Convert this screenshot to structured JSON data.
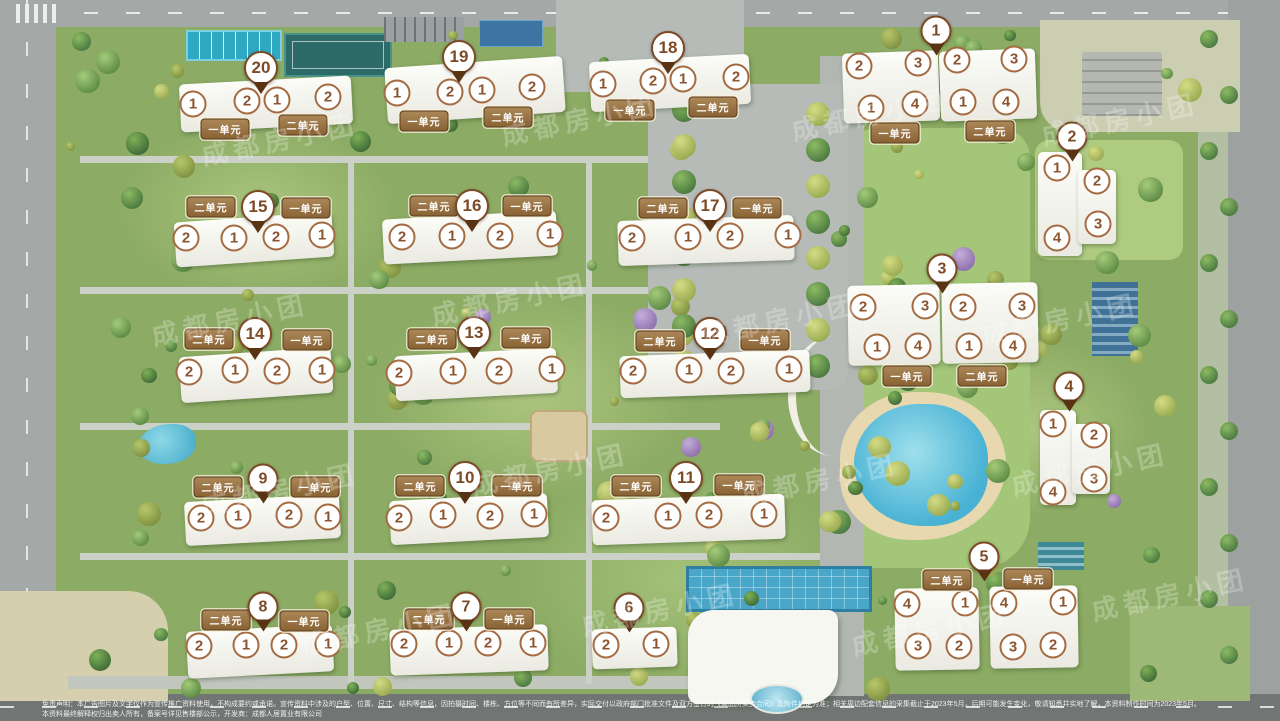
{
  "watermark": {
    "text": "成都房小团",
    "instances": [
      [
        200,
        120
      ],
      [
        500,
        100
      ],
      [
        790,
        95
      ],
      [
        1040,
        100
      ],
      [
        150,
        300
      ],
      [
        430,
        280
      ],
      [
        700,
        300
      ],
      [
        980,
        300
      ],
      [
        200,
        470
      ],
      [
        470,
        450
      ],
      [
        740,
        460
      ],
      [
        1010,
        450
      ],
      [
        300,
        610
      ],
      [
        580,
        590
      ],
      [
        850,
        610
      ],
      [
        1090,
        575
      ]
    ]
  },
  "colors": {
    "marker_brown": "#7d4a26",
    "unit_label_bg": "#96744a",
    "circle_ring": "#a46b42",
    "pool_blue": "#49b2d4",
    "lawn_green": "#8cab64",
    "road_gray": "#a4a8a6"
  },
  "disclaimer": {
    "line1": "免责声明：本广告图片及文字仅作为宣传推广资料使用，不构成要约或承诺。宣传资料中涉及的户型、位置、尺寸、结构等信息，因拍摄时间、楼栋、方位等不同而有所差异，实际交付以政府部门批准文件及双方签订的《商品房买卖合同》及附件约定为准；相关周边配套信息的采集截止于2023年5月，后期可能发生变化，敬请知悉并实地了解，本资料制作时间为2023年5月。",
    "line2": "本资料最终解释权归出卖人所有，备案号详见售楼部公示，开发商：成都人居置业有限公司"
  },
  "buildings": [
    {
      "num": "20",
      "rot": -3,
      "pin": [
        261,
        68
      ],
      "slabs": [
        [
          180,
          80,
          172,
          48
        ]
      ],
      "units": [
        [
          "一单元",
          225,
          129
        ],
        [
          "二单元",
          303,
          125
        ]
      ],
      "circles": [
        [
          "1",
          193,
          104
        ],
        [
          "2",
          247,
          101
        ],
        [
          "1",
          277,
          100
        ],
        [
          "2",
          328,
          97
        ]
      ]
    },
    {
      "num": "19",
      "rot": -4,
      "pin": [
        459,
        57
      ],
      "slabs": [
        [
          386,
          62,
          178,
          56
        ]
      ],
      "units": [
        [
          "一单元",
          424,
          121
        ],
        [
          "二单元",
          508,
          117
        ]
      ],
      "circles": [
        [
          "1",
          397,
          93
        ],
        [
          "2",
          450,
          92
        ],
        [
          "1",
          482,
          90
        ],
        [
          "2",
          532,
          87
        ]
      ]
    },
    {
      "num": "18",
      "rot": -3,
      "pin": [
        668,
        48
      ],
      "slabs": [
        [
          590,
          58,
          160,
          50
        ]
      ],
      "units": [
        [
          "一单元",
          630,
          110
        ],
        [
          "二单元",
          713,
          107
        ]
      ],
      "circles": [
        [
          "1",
          603,
          84
        ],
        [
          "2",
          653,
          81
        ],
        [
          "1",
          683,
          79
        ],
        [
          "2",
          736,
          77
        ]
      ]
    },
    {
      "num": "1",
      "rot": -2,
      "pin": [
        936,
        31
      ],
      "slabs": [
        [
          843,
          52,
          96,
          70
        ],
        [
          940,
          50,
          96,
          70
        ]
      ],
      "units": [
        [
          "一单元",
          895,
          133
        ],
        [
          "二单元",
          990,
          131
        ]
      ],
      "circles": [
        [
          "2",
          859,
          66
        ],
        [
          "3",
          918,
          63
        ],
        [
          "2",
          957,
          60
        ],
        [
          "3",
          1014,
          59
        ],
        [
          "1",
          871,
          108
        ],
        [
          "4",
          915,
          104
        ],
        [
          "1",
          963,
          102
        ],
        [
          "4",
          1006,
          102
        ]
      ]
    },
    {
      "num": "2",
      "rot": 0,
      "pin": [
        1072,
        137
      ],
      "slabs": [
        [
          1038,
          152,
          44,
          104
        ],
        [
          1078,
          170,
          38,
          74
        ]
      ],
      "units": [],
      "circles": [
        [
          "1",
          1057,
          168
        ],
        [
          "2",
          1097,
          181
        ],
        [
          "3",
          1098,
          224
        ],
        [
          "4",
          1057,
          238
        ]
      ]
    },
    {
      "num": "15",
      "rot": -4,
      "pin": [
        258,
        207
      ],
      "slabs": [
        [
          175,
          217,
          158,
          45
        ]
      ],
      "units": [
        [
          "二单元",
          211,
          207
        ],
        [
          "一单元",
          306,
          208
        ]
      ],
      "circles": [
        [
          "2",
          186,
          238
        ],
        [
          "1",
          234,
          238
        ],
        [
          "2",
          276,
          237
        ],
        [
          "1",
          322,
          235
        ]
      ]
    },
    {
      "num": "16",
      "rot": -3,
      "pin": [
        472,
        206
      ],
      "slabs": [
        [
          383,
          215,
          174,
          45
        ]
      ],
      "units": [
        [
          "二单元",
          434,
          206
        ],
        [
          "一单元",
          527,
          206
        ]
      ],
      "circles": [
        [
          "2",
          402,
          237
        ],
        [
          "1",
          452,
          236
        ],
        [
          "2",
          500,
          236
        ],
        [
          "1",
          550,
          234
        ]
      ]
    },
    {
      "num": "17",
      "rot": -2,
      "pin": [
        710,
        206
      ],
      "slabs": [
        [
          618,
          218,
          176,
          45
        ]
      ],
      "units": [
        [
          "二单元",
          663,
          208
        ],
        [
          "一单元",
          757,
          208
        ]
      ],
      "circles": [
        [
          "2",
          632,
          238
        ],
        [
          "1",
          688,
          237
        ],
        [
          "2",
          730,
          236
        ],
        [
          "1",
          788,
          235
        ]
      ]
    },
    {
      "num": "3",
      "rot": -1,
      "pin": [
        942,
        269
      ],
      "slabs": [
        [
          848,
          285,
          92,
          80
        ],
        [
          942,
          283,
          96,
          80
        ]
      ],
      "units": [
        [
          "一单元",
          907,
          376
        ],
        [
          "二单元",
          982,
          376
        ]
      ],
      "circles": [
        [
          "2",
          863,
          307
        ],
        [
          "3",
          925,
          306
        ],
        [
          "2",
          963,
          307
        ],
        [
          "3",
          1022,
          306
        ],
        [
          "1",
          877,
          347
        ],
        [
          "4",
          918,
          346
        ],
        [
          "1",
          969,
          346
        ],
        [
          "4",
          1013,
          346
        ]
      ]
    },
    {
      "num": "14",
      "rot": -4,
      "pin": [
        255,
        334
      ],
      "slabs": [
        [
          180,
          352,
          152,
          46
        ]
      ],
      "units": [
        [
          "二单元",
          209,
          339
        ],
        [
          "一单元",
          307,
          340
        ]
      ],
      "circles": [
        [
          "2",
          189,
          372
        ],
        [
          "1",
          235,
          370
        ],
        [
          "2",
          277,
          371
        ],
        [
          "1",
          322,
          370
        ]
      ]
    },
    {
      "num": "13",
      "rot": -3,
      "pin": [
        474,
        333
      ],
      "slabs": [
        [
          395,
          352,
          162,
          45
        ]
      ],
      "units": [
        [
          "二单元",
          432,
          339
        ],
        [
          "一单元",
          526,
          338
        ]
      ],
      "circles": [
        [
          "2",
          399,
          373
        ],
        [
          "1",
          453,
          371
        ],
        [
          "2",
          499,
          371
        ],
        [
          "1",
          552,
          369
        ]
      ]
    },
    {
      "num": "12",
      "rot": -2,
      "pin": [
        710,
        334
      ],
      "slabs": [
        [
          620,
          353,
          190,
          42
        ]
      ],
      "units": [
        [
          "二单元",
          660,
          341
        ],
        [
          "一单元",
          765,
          340
        ]
      ],
      "circles": [
        [
          "2",
          633,
          371
        ],
        [
          "1",
          689,
          370
        ],
        [
          "2",
          731,
          371
        ],
        [
          "1",
          789,
          369
        ]
      ]
    },
    {
      "num": "4",
      "rot": 0,
      "pin": [
        1069,
        387
      ],
      "slabs": [
        [
          1040,
          410,
          36,
          95
        ],
        [
          1072,
          424,
          38,
          70
        ]
      ],
      "units": [],
      "circles": [
        [
          "1",
          1053,
          424
        ],
        [
          "2",
          1094,
          435
        ],
        [
          "3",
          1094,
          479
        ],
        [
          "4",
          1053,
          492
        ]
      ]
    },
    {
      "num": "9",
      "rot": -3,
      "pin": [
        263,
        479
      ],
      "slabs": [
        [
          185,
          498,
          155,
          44
        ]
      ],
      "units": [
        [
          "二单元",
          218,
          487
        ],
        [
          "一单元",
          315,
          487
        ]
      ],
      "circles": [
        [
          "2",
          201,
          518
        ],
        [
          "1",
          238,
          516
        ],
        [
          "2",
          289,
          515
        ],
        [
          "1",
          328,
          517
        ]
      ]
    },
    {
      "num": "10",
      "rot": -3,
      "pin": [
        465,
        478
      ],
      "slabs": [
        [
          390,
          497,
          158,
          44
        ]
      ],
      "units": [
        [
          "二单元",
          420,
          486
        ],
        [
          "一单元",
          517,
          486
        ]
      ],
      "circles": [
        [
          "2",
          399,
          518
        ],
        [
          "1",
          443,
          515
        ],
        [
          "2",
          490,
          516
        ],
        [
          "1",
          534,
          514
        ]
      ]
    },
    {
      "num": "11",
      "rot": -2,
      "pin": [
        686,
        478
      ],
      "slabs": [
        [
          592,
          497,
          193,
          45
        ]
      ],
      "units": [
        [
          "二单元",
          636,
          486
        ],
        [
          "一单元",
          739,
          485
        ]
      ],
      "circles": [
        [
          "2",
          606,
          518
        ],
        [
          "1",
          668,
          516
        ],
        [
          "2",
          709,
          515
        ],
        [
          "1",
          764,
          514
        ]
      ]
    },
    {
      "num": "5",
      "rot": -1,
      "pin": [
        984,
        557
      ],
      "slabs": [
        [
          895,
          588,
          84,
          82
        ],
        [
          990,
          586,
          88,
          82
        ]
      ],
      "units": [
        [
          "二单元",
          947,
          580
        ],
        [
          "一单元",
          1028,
          579
        ]
      ],
      "circles": [
        [
          "4",
          907,
          604
        ],
        [
          "1",
          965,
          603
        ],
        [
          "4",
          1004,
          603
        ],
        [
          "1",
          1063,
          602
        ],
        [
          "3",
          918,
          646
        ],
        [
          "2",
          959,
          646
        ],
        [
          "3",
          1013,
          647
        ],
        [
          "2",
          1053,
          645
        ]
      ]
    },
    {
      "num": "8",
      "rot": -3,
      "pin": [
        263,
        607
      ],
      "slabs": [
        [
          187,
          628,
          146,
          47
        ]
      ],
      "units": [
        [
          "二单元",
          226,
          620
        ],
        [
          "一单元",
          304,
          621
        ]
      ],
      "circles": [
        [
          "2",
          199,
          646
        ],
        [
          "1",
          246,
          645
        ],
        [
          "2",
          284,
          645
        ],
        [
          "1",
          328,
          644
        ]
      ]
    },
    {
      "num": "7",
      "rot": -2,
      "pin": [
        466,
        607
      ],
      "slabs": [
        [
          390,
          627,
          158,
          46
        ]
      ],
      "units": [
        [
          "二单元",
          429,
          619
        ],
        [
          "一单元",
          509,
          619
        ]
      ],
      "circles": [
        [
          "2",
          404,
          644
        ],
        [
          "1",
          449,
          643
        ],
        [
          "2",
          488,
          643
        ],
        [
          "1",
          533,
          643
        ]
      ]
    },
    {
      "num": "6",
      "rot": -2,
      "pin": [
        629,
        608
      ],
      "slabs": [
        [
          592,
          628,
          85,
          40
        ]
      ],
      "units": [],
      "circles": [
        [
          "2",
          606,
          645
        ],
        [
          "1",
          656,
          644
        ]
      ]
    }
  ]
}
